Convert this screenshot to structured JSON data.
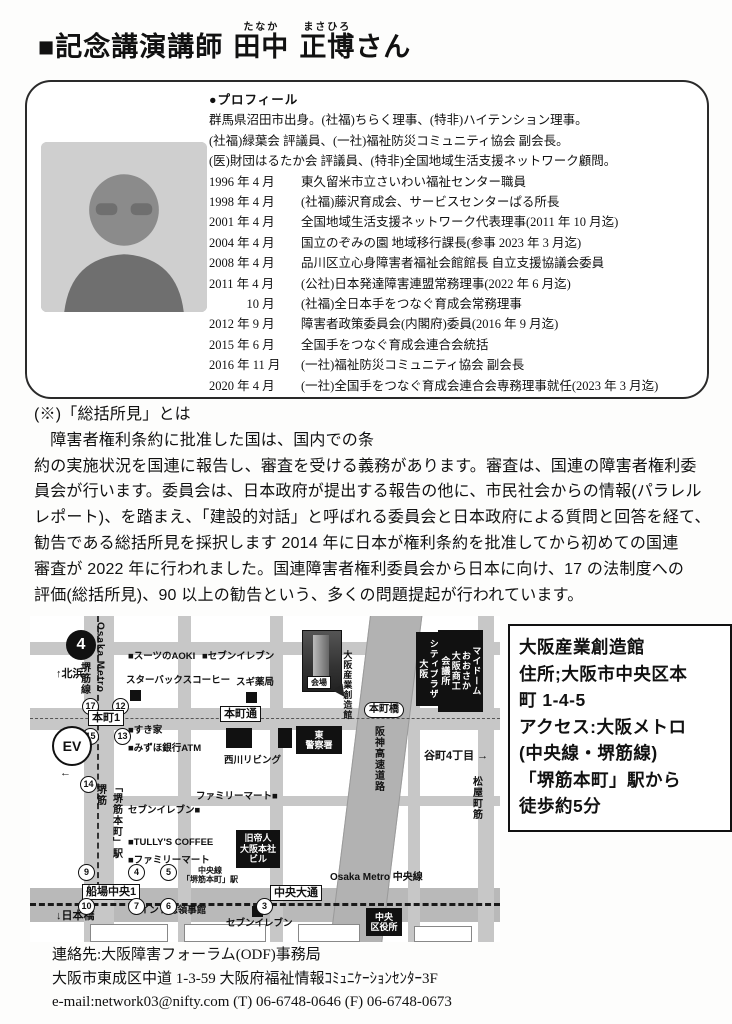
{
  "title": {
    "marker": "■記念講演講師",
    "name1": "田中",
    "kana1": "たなか",
    "name2": "正博",
    "kana2": "まさひろ",
    "suffix": "さん"
  },
  "profile": {
    "heading": "●プロフィール",
    "intro": [
      "群馬県沼田市出身。(社福)ちらく理事、(特非)ハイテンション理事。",
      "(社福)緑葉会 評議員、(一社)福祉防災コミュニティ協会 副会長。",
      "(医)財団はるたか会 評議員、(特非)全国地域生活支援ネットワーク顧問。"
    ],
    "career": [
      {
        "date": "1996 年 4 月",
        "desc": "東久留米市立さいわい福祉センター職員"
      },
      {
        "date": "1998 年 4 月",
        "desc": "(社福)藤沢育成会、サービスセンターぱる所長"
      },
      {
        "date": "2001 年 4 月",
        "desc": "全国地域生活支援ネットワーク代表理事(2011 年 10 月迄)"
      },
      {
        "date": "2004 年 4 月",
        "desc": "国立のぞみの園 地域移行課長(参事 2023 年 3 月迄)"
      },
      {
        "date": "2008 年 4 月",
        "desc": "品川区立心身障害者福祉会館館長 自立支援協議会委員"
      },
      {
        "date": "2011 年 4 月",
        "desc": "(公社)日本発達障害連盟常務理事(2022 年 6 月迄)"
      },
      {
        "date": "　　　10 月",
        "desc": "(社福)全日本手をつなぐ育成会常務理事"
      },
      {
        "date": "2012 年 9 月",
        "desc": "障害者政策委員会(内閣府)委員(2016 年 9 月迄)"
      },
      {
        "date": "2015 年 6 月",
        "desc": "全国手をつなぐ育成会連合会統括"
      },
      {
        "date": "2016 年 11 月",
        "desc": "(一社)福祉防災コミュニティ協会 副会長"
      },
      {
        "date": "2020 年 4 月",
        "desc": "(一社)全国手をつなぐ育成会連合会専務理事就任(2023 年 3 月迄)"
      }
    ]
  },
  "explanation": {
    "heading": "(※)「総括所見」とは",
    "lines": [
      "　障害者権利条約に批准した国は、国内での条",
      "約の実施状況を国連に報告し、審査を受ける義務があります。審査は、国連の障害者権利委",
      "員会が行います。委員会は、日本政府が提出する報告の他に、市民社会からの情報(パラレル",
      "レポート)、を踏まえ、「建設的対話」と呼ばれる委員会と日本政府による質問と回答を経て、",
      "勧告である総括所見を採択します 2014 年に日本が権利条約を批准してから初めての国連",
      "審査が 2022 年に行われました。国連障害者権利委員会から日本に向け、17 の法制度への",
      "評価(総括所見)、90 以上の勧告という、多くの問題提起が行われています。"
    ]
  },
  "venue_box": {
    "lines": [
      "大阪産業創造館",
      "住所;大阪市中央区本",
      "町 1-4-5",
      "アクセス:大阪メトロ",
      "(中央線・堺筋線)",
      "「堺筋本町」駅から",
      "徒歩約5分"
    ]
  },
  "contact": {
    "lines": [
      "連絡先:大阪障害フォーラム(ODF)事務局",
      "大阪市東成区中道 1-3-59 大阪府福祉情報ｺﾐｭﾆｹｰｼｮﾝｾﾝﾀｰ3F",
      "e-mail:network03@nifty.com (T) 06-6748-0646 (F) 06-6748-0673"
    ]
  },
  "map": {
    "venue_photo_label": "会場",
    "venue_photo_name": "大阪産業創造館",
    "labels": [
      {
        "k": "bcirc",
        "text": "4",
        "x": 36,
        "y": 14,
        "n": "route-sign-4"
      },
      {
        "k": "arrow",
        "text": "↑北浜",
        "x": 26,
        "y": 52,
        "n": "north-kitahama-arrow"
      },
      {
        "k": "vt",
        "text": "Osaka Metro",
        "x": 64,
        "y": 6,
        "h": 92,
        "n": "osaka-metro-sakaisuji-line-label"
      },
      {
        "k": "vt",
        "text": "堺筋線",
        "x": 48,
        "y": 46,
        "h": 46,
        "n": "sakaisuji-line-label"
      },
      {
        "k": "circ",
        "text": "17",
        "x": 52,
        "y": 82,
        "n": "exit-17"
      },
      {
        "k": "circ",
        "text": "12",
        "x": 82,
        "y": 82,
        "n": "exit-12"
      },
      {
        "k": "roadbox",
        "text": "本町1",
        "x": 58,
        "y": 94,
        "n": "honmachi-1-intersection"
      },
      {
        "k": "circ",
        "text": "15",
        "x": 52,
        "y": 112,
        "n": "exit-15"
      },
      {
        "k": "circ",
        "text": "13",
        "x": 84,
        "y": 112,
        "n": "exit-13"
      },
      {
        "k": "ev",
        "text": "EV",
        "x": 22,
        "y": 110,
        "n": "elevator-marker"
      },
      {
        "k": "arrow",
        "text": "本町\n←",
        "x": 30,
        "y": 138,
        "n": "west-honmachi-arrow"
      },
      {
        "k": "poi",
        "text": "■スーツのAOKI",
        "x": 98,
        "y": 36,
        "n": "poi-suits-aoki"
      },
      {
        "k": "poi",
        "text": "■セブンイレブン",
        "x": 172,
        "y": 36,
        "n": "poi-seven-eleven-top"
      },
      {
        "k": "poi-plain",
        "text": "スターバックスコーヒー",
        "x": 96,
        "y": 60,
        "n": "poi-starbucks"
      },
      {
        "k": "sq",
        "text": "",
        "x": 100,
        "y": 74,
        "n": "poi-starbucks-marker"
      },
      {
        "k": "poi-plain",
        "text": "スギ薬局",
        "x": 206,
        "y": 62,
        "n": "poi-sugi-pharmacy"
      },
      {
        "k": "sq",
        "text": "",
        "x": 216,
        "y": 76,
        "n": "poi-sugi-marker"
      },
      {
        "k": "roadbox",
        "text": "本町通",
        "x": 190,
        "y": 90,
        "n": "honmachi-dori-label"
      },
      {
        "k": "poi",
        "text": "■すき家",
        "x": 98,
        "y": 110,
        "n": "poi-sukiya"
      },
      {
        "k": "poi",
        "text": "■みずほ銀行ATM",
        "x": 98,
        "y": 128,
        "n": "poi-mizuho-atm"
      },
      {
        "k": "blk",
        "text": "",
        "x": 196,
        "y": 112,
        "w": 26,
        "h": 20,
        "n": "building-block"
      },
      {
        "k": "blk",
        "text": "",
        "x": 248,
        "y": 112,
        "w": 14,
        "h": 20,
        "n": "building-block"
      },
      {
        "k": "bb",
        "text": "東\n警察署",
        "x": 266,
        "y": 110,
        "w": 46,
        "h": 28,
        "n": "higashi-police-station"
      },
      {
        "k": "poi-plain",
        "text": "西川リビング",
        "x": 194,
        "y": 140,
        "n": "poi-nishikawa-living"
      },
      {
        "k": "roadbox-round",
        "text": "本町橋",
        "x": 334,
        "y": 86,
        "n": "honmachibashi-label"
      },
      {
        "k": "bbv",
        "text": "シティプラザ大阪",
        "x": 386,
        "y": 16,
        "h": 66,
        "n": "city-plaza-osaka"
      },
      {
        "k": "bbv",
        "text": "マイドーム\nおおさか\n大阪商工\n会議所",
        "x": 408,
        "y": 14,
        "h": 74,
        "n": "mydome-osaka-cci"
      },
      {
        "k": "vt",
        "text": "阪神高速道路",
        "x": 342,
        "y": 110,
        "h": 86,
        "n": "hanshin-expressway-label"
      },
      {
        "k": "arrow",
        "text": "谷町4丁目 →",
        "x": 394,
        "y": 134,
        "n": "tanimachi-4-arrow"
      },
      {
        "k": "vt",
        "text": "松屋町筋",
        "x": 440,
        "y": 160,
        "h": 58,
        "n": "matsuyamachi-suji-label"
      },
      {
        "k": "poi",
        "text": "ファミリーマート■",
        "x": 166,
        "y": 176,
        "n": "poi-familymart-upper"
      },
      {
        "k": "circ",
        "text": "14",
        "x": 50,
        "y": 160,
        "n": "exit-14"
      },
      {
        "k": "vt",
        "text": "堺筋",
        "x": 64,
        "y": 168,
        "h": 30,
        "n": "sakaisuji-label"
      },
      {
        "k": "vt",
        "text": "「堺筋本町」駅",
        "x": 80,
        "y": 166,
        "h": 78,
        "n": "sakaisuji-honmachi-station-label"
      },
      {
        "k": "poi",
        "text": "セブンイレブン■",
        "x": 98,
        "y": 190,
        "n": "poi-seven-eleven-mid"
      },
      {
        "k": "poi",
        "text": "■TULLY'S COFFEE",
        "x": 98,
        "y": 222,
        "n": "poi-tullys-coffee"
      },
      {
        "k": "poi",
        "text": "■ファミリーマート",
        "x": 98,
        "y": 240,
        "n": "poi-familymart-lower"
      },
      {
        "k": "bb",
        "text": "旧帝人\n大阪本社\nビル",
        "x": 206,
        "y": 214,
        "w": 44,
        "h": 38,
        "n": "former-teijin-building"
      },
      {
        "k": "circ",
        "text": "9",
        "x": 48,
        "y": 248,
        "n": "exit-9"
      },
      {
        "k": "circ",
        "text": "4",
        "x": 98,
        "y": 248,
        "n": "exit-4"
      },
      {
        "k": "circ",
        "text": "5",
        "x": 130,
        "y": 248,
        "n": "exit-5"
      },
      {
        "k": "small2",
        "text": "中央線\n「堺筋本町」駅",
        "x": 152,
        "y": 250,
        "n": "chuo-line-station-label"
      },
      {
        "k": "roadbox",
        "text": "船場中央1",
        "x": 52,
        "y": 268,
        "n": "semba-chuo-1"
      },
      {
        "k": "rail",
        "text": "Osaka Metro 中央線",
        "x": 300,
        "y": 256,
        "n": "osaka-metro-chuo-line-label"
      },
      {
        "k": "roadbox",
        "text": "中央大通",
        "x": 240,
        "y": 269,
        "n": "chuo-odori-label"
      },
      {
        "k": "circ",
        "text": "10",
        "x": 48,
        "y": 282,
        "n": "exit-10"
      },
      {
        "k": "circ",
        "text": "7",
        "x": 98,
        "y": 282,
        "n": "exit-7"
      },
      {
        "k": "circ",
        "text": "6",
        "x": 130,
        "y": 282,
        "n": "exit-6"
      },
      {
        "k": "circ",
        "text": "3",
        "x": 226,
        "y": 282,
        "n": "exit-3"
      },
      {
        "k": "poi",
        "text": "■インド総領事館",
        "x": 104,
        "y": 290,
        "n": "poi-india-consulate"
      },
      {
        "k": "sq",
        "text": "",
        "x": 222,
        "y": 290,
        "n": "poi-seven-eleven-marker"
      },
      {
        "k": "poi-plain",
        "text": "セブンイレブン",
        "x": 196,
        "y": 303,
        "n": "poi-seven-eleven-bottom"
      },
      {
        "k": "arrow",
        "text": "↓日本橋",
        "x": 26,
        "y": 294,
        "n": "south-nipponbashi-arrow"
      },
      {
        "k": "bb",
        "text": "中央\n区役所",
        "x": 336,
        "y": 292,
        "w": 36,
        "h": 28,
        "n": "chuo-ward-office"
      }
    ]
  }
}
